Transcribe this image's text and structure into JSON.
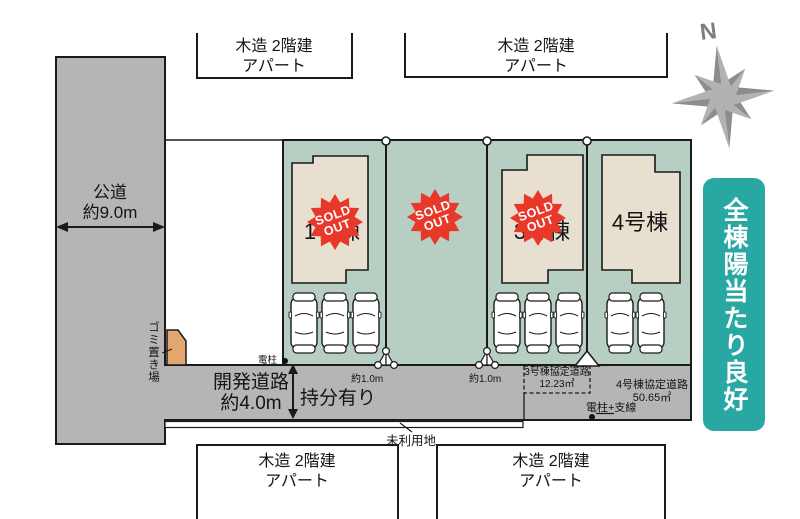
{
  "plan": {
    "north_label": "N",
    "banner": {
      "text": "全棟陽当たり良好"
    },
    "neighbors": {
      "top_left": {
        "line1": "木造 2階建",
        "line2": "アパート"
      },
      "top_right": {
        "line1": "木造 2階建",
        "line2": "アパート"
      },
      "bottom_left": {
        "line1": "木造 2階建",
        "line2": "アパート"
      },
      "bottom_right": {
        "line1": "木造 2階建",
        "line2": "アパート"
      }
    },
    "roads": {
      "public": {
        "name": "公道",
        "width": "約9.0m"
      },
      "development": {
        "name": "開発道路",
        "width": "約4.0m"
      },
      "ownership_note": "持分有り",
      "agreement_road_3": {
        "name": "3号棟協定道路",
        "area": "12.23㎡"
      },
      "agreement_road_4": {
        "name": "4号棟協定道路",
        "area": "50.65㎡"
      }
    },
    "annotations": {
      "garbage_area": "ゴミ置き場",
      "utility_pole": "電柱",
      "utility_pole_wire": "電柱+支線",
      "unused_land": "未利用地",
      "offset_left": "約1.0m",
      "offset_right": "約1.0m"
    },
    "lots": [
      {
        "label": "1号棟",
        "sold": true
      },
      {
        "label": "",
        "sold": true
      },
      {
        "label": "3号棟",
        "sold": true
      },
      {
        "label": "4号棟",
        "sold": false
      }
    ],
    "sold_stamp": {
      "line1": "SOLD",
      "line2": "OUT"
    },
    "colors": {
      "site_green": "#b6cfc2",
      "road_gray": "#b5b5b7",
      "building_beige": "#e7dfcf",
      "sold_red": "#e8382a",
      "banner_teal": "#29a7a2",
      "garbage_orange": "#e4a66f",
      "compass_gray": "#8d8d8d"
    }
  }
}
